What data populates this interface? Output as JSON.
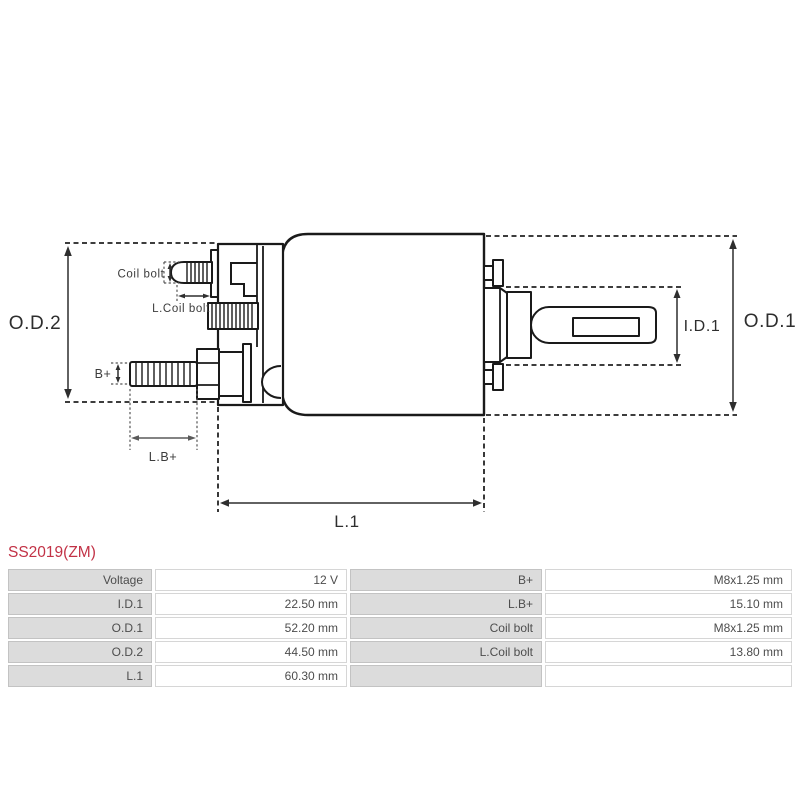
{
  "part": {
    "number": "SS2019(ZM)"
  },
  "diagram": {
    "labels": {
      "od2": "O.D.2",
      "od1": "O.D.1",
      "id1": "I.D.1",
      "l1": "L.1",
      "lb_plus": "L.B+",
      "b_plus": "B+",
      "coil_bolt": "Coil bolt",
      "l_coil_bolt": "L.Coil bolt"
    }
  },
  "spec_table": {
    "rows": [
      [
        "Voltage",
        "12 V",
        "B+",
        "M8x1.25 mm"
      ],
      [
        "I.D.1",
        "22.50 mm",
        "L.B+",
        "15.10 mm"
      ],
      [
        "O.D.1",
        "52.20 mm",
        "Coil bolt",
        "M8x1.25 mm"
      ],
      [
        "O.D.2",
        "44.50 mm",
        "L.Coil bolt",
        "13.80 mm"
      ],
      [
        "L.1",
        "60.30 mm",
        "",
        ""
      ]
    ]
  },
  "colors": {
    "accent_red": "#c23246",
    "line_black": "#1a1a1a",
    "cell_gray": "#dcdcdc",
    "cell_white": "#ffffff",
    "text_gray": "#4d4d4d"
  }
}
